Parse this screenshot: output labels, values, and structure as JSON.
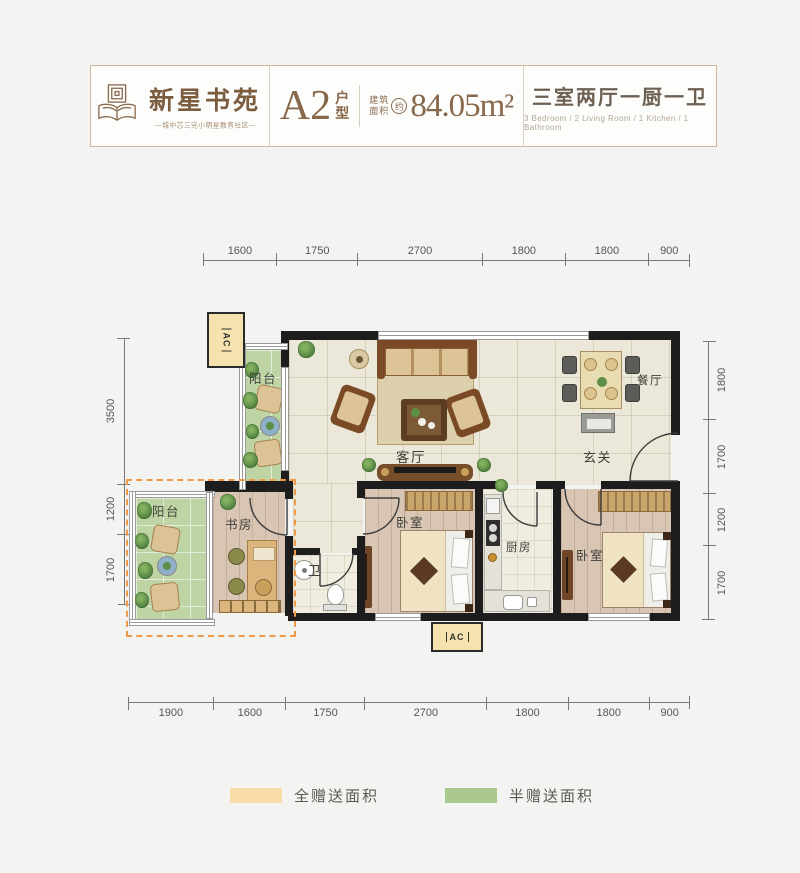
{
  "header": {
    "logo": {
      "title": "新星书苑",
      "tagline": "—城中芯三完小明星教育社区—"
    },
    "unit": {
      "code": "A2",
      "suffix": "户型",
      "area_label": "建筑面积",
      "area_circle": "约",
      "area_value": "84.05m²"
    },
    "layout": {
      "cn": "三室两厅一厨一卫",
      "en": "3 Bedroom / 2 Living Room / 1 Kitchen / 1 Bathroom"
    }
  },
  "dimensions": {
    "top": [
      "1600",
      "1750",
      "2700",
      "1800",
      "1800",
      "900"
    ],
    "bottom": [
      "1900",
      "1600",
      "1750",
      "2700",
      "1800",
      "1800",
      "900"
    ],
    "left": [
      "3500",
      "1200",
      "1700"
    ],
    "right": [
      "1800",
      "1700",
      "1200",
      "1700"
    ]
  },
  "rooms": {
    "balcony_top": "阳台",
    "living": "客厅",
    "dining": "餐厅",
    "entry": "玄关",
    "balcony_bottom": "阳台",
    "study": "书房",
    "bath": "卫",
    "bedroom_mid": "卧室",
    "kitchen": "厨房",
    "bedroom_right": "卧室",
    "ac": "AC"
  },
  "legend": [
    {
      "label": "全赠送面积",
      "color": "#f7dca7"
    },
    {
      "label": "半赠送面积",
      "color": "#abc98f"
    }
  ],
  "colors": {
    "accent_orange": "#ee9a47",
    "balcony_green": "#bed4a4",
    "gift_full": "#f7dca7",
    "gift_half": "#abc98f",
    "wall": "#1d1d1d",
    "brand_brown": "#87684a"
  }
}
